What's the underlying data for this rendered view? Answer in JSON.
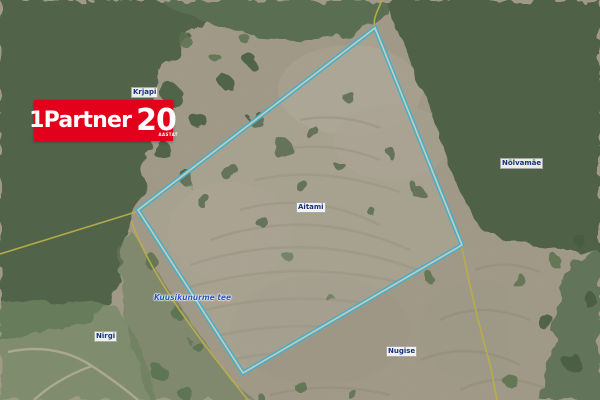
{
  "logo": {
    "brand": "1Partner",
    "number": "20",
    "subtext": "AASTAT",
    "bg_color": "#e2001a",
    "text_color": "#ffffff"
  },
  "map": {
    "type": "aerial-cadastral-orthophoto",
    "parcel": {
      "outline_color": "#3cc6e6",
      "points": "375,28 462,245 243,373 138,210"
    },
    "cadastral_lines": {
      "color": "#d6c63d",
      "nw": "M382,0 C378,10 372,20 375,28 L139,211 L0,254",
      "road_west": "M131,221 C152,278 198,338 248,400",
      "right": "M462,247 C469,285 481,333 491,368 L497,400"
    },
    "place_labels": [
      {
        "text": "Krjapi",
        "x": 131,
        "y": 87
      },
      {
        "text": "Aitami",
        "x": 296,
        "y": 202
      },
      {
        "text": "Nõlvamäe",
        "x": 500,
        "y": 158
      },
      {
        "text": "Nirgi",
        "x": 94,
        "y": 331
      },
      {
        "text": "Nugise",
        "x": 386,
        "y": 346
      }
    ],
    "road_label": {
      "text": "Kuusikunurme tee",
      "x": 154,
      "y": 293
    },
    "colors": {
      "forest": "#4a6440",
      "clearing": "#b3aa93",
      "parcel_outline": "#3cc6e6",
      "cadastral_line": "#d6c63d"
    }
  }
}
